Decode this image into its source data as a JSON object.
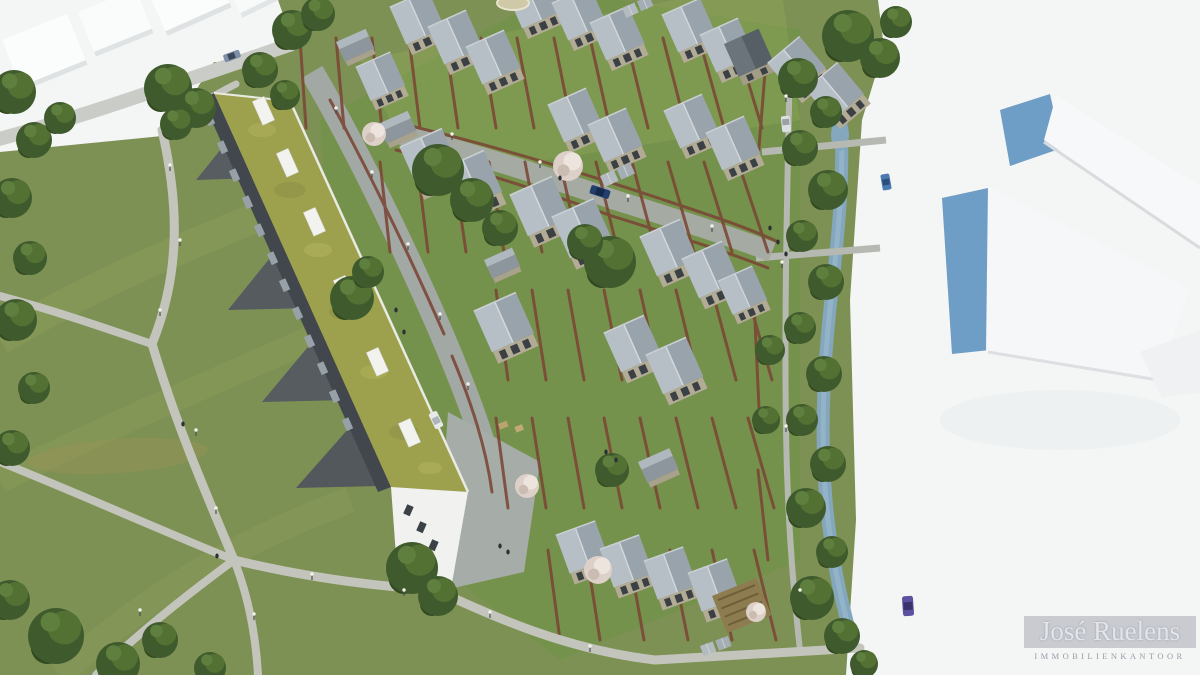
{
  "meta": {
    "type": "aerial architectural rendering",
    "width": 1200,
    "height": 675,
    "description": "Bird's-eye 3D visualisation of a residential development: stepped rows of gabled houses with red-brick walled gardens, a long linear apartment block with a green sedum roof and skylights beside a public park with branching footpaths, lamp posts, a stream lined with trees, and surrounding existing buildings shown as white massing volumes"
  },
  "logo": {
    "name": "José Ruelens",
    "subtitle": "IMMOBILIENKANTOOR"
  },
  "palette": {
    "park_grass": "#7e9154",
    "garden_grass": "#739349",
    "sunlit_grass": "#8fa757",
    "tree_dark": "#3f5b2d",
    "tree_light": "#547134",
    "blossom": "#ddd0c8",
    "roof_light": "#b7bfc6",
    "roof_dark": "#99a3ab",
    "wall_beige": "#b2ab95",
    "brick_wall": "#7b4636",
    "path_gray": "#c3c5bd",
    "street_gray": "#a5aaa2",
    "green_roof": "#9da14e",
    "dark_facade": "#42474d",
    "white_context": "#f4f5f5",
    "water": "#84a7bd",
    "glass_blue": "#6e9dc5",
    "logo_text": "#e3e5ec",
    "logo_subtext": "#979da6"
  },
  "scene": {
    "house_units": 26,
    "apartment_block": {
      "roof": "green sedum",
      "skylights": 6,
      "balconies": 12
    },
    "cars": 6,
    "watermark_position": "bottom-right"
  }
}
